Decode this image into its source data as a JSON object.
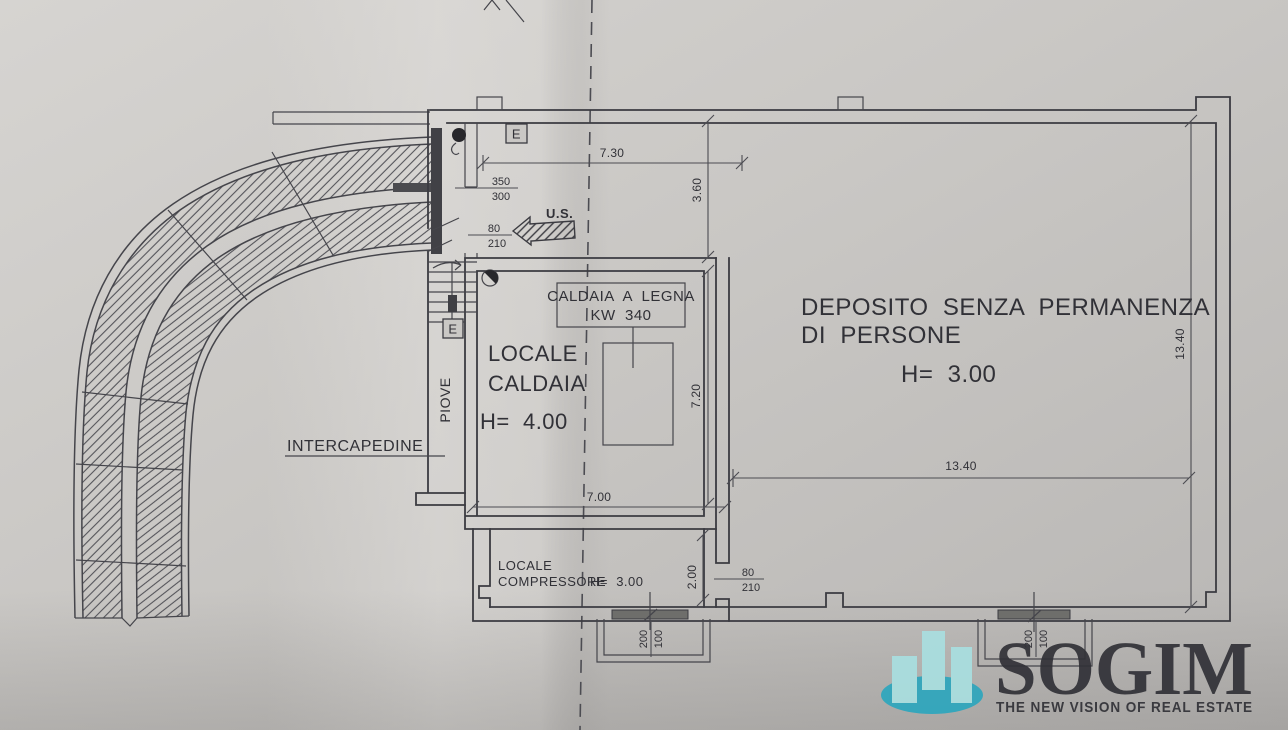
{
  "drawing": {
    "rooms": {
      "deposito": {
        "name_line1": "DEPOSITO  SENZA  PERMANENZA",
        "name_line2": "DI  PERSONE",
        "height": "H=  3.00"
      },
      "locale_caldaia": {
        "name_line1": "LOCALE",
        "name_line2": "CALDAIA",
        "height": "H=  4.00"
      },
      "locale_compressore": {
        "name_line1": "LOCALE",
        "name_line2": "COMPRESSORE",
        "height": "H=  3.00"
      }
    },
    "equipment": {
      "boiler_line1": "CALDAIA  A  LEGNA",
      "boiler_line2": "KW  340"
    },
    "labels": {
      "intercapedine": "INTERCAPEDINE",
      "piove": "PIOVE",
      "exit": "U.S.",
      "electrical_marker": "E"
    },
    "dimensions": {
      "upper_width": "7.30",
      "upper_depth": "3.60",
      "caldaia_depth": "7.20",
      "caldaia_width": "7.00",
      "deposito_width": "13.40",
      "deposito_depth": "13.40",
      "compressore_depth": "2.00",
      "opening_main": {
        "w": "350",
        "h": "300"
      },
      "door_exit": {
        "w": "80",
        "h": "210"
      },
      "door_deposito": {
        "w": "80",
        "h": "210"
      },
      "window_compressore": {
        "w": "200",
        "h": "100"
      },
      "window_deposito": {
        "w": "200",
        "h": "100"
      }
    }
  },
  "watermark": {
    "brand": "SOGIM",
    "tagline": "THE NEW VISION OF REAL ESTATE",
    "brand_color": "#2ba7c6",
    "bar_color": "#a9dfe0",
    "ellipse_color": "#2da6bd"
  },
  "photo": {
    "paper_color": "#c8c6c3",
    "ink_color": "#3b3b41"
  }
}
